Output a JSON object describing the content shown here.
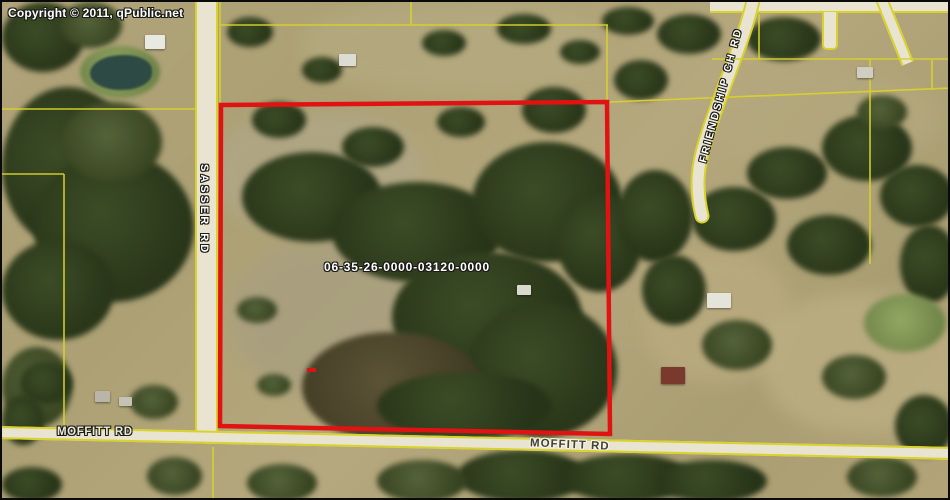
{
  "map": {
    "copyright": "Copyright © 2011, qPublic.net",
    "parcel": {
      "id": "06-35-26-0000-03120-0000",
      "boundary_color": "#e01212"
    },
    "roads": [
      {
        "name": "SASSER RD",
        "orientation": "vertical"
      },
      {
        "name": "MOFFITT RD",
        "orientation": "horizontal-left"
      },
      {
        "name": "MOFFITT RD",
        "orientation": "horizontal-right"
      },
      {
        "name": "FRIENDSHIP CH RD",
        "orientation": "diagonal"
      }
    ],
    "colors": {
      "parcel_line_yellow": "#d8d22b",
      "road_fill": "#e9e4d1",
      "field_tan": "#b1a37a",
      "forest_green": "#2f3e1f",
      "water": "#2d4a44"
    }
  }
}
